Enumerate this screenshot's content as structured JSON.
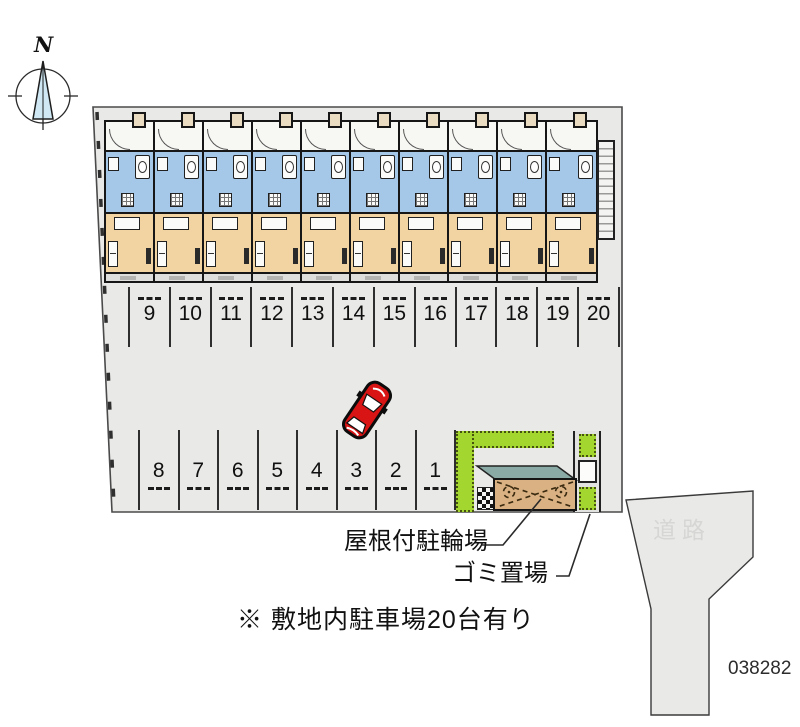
{
  "plan_id": "038282",
  "compass": {
    "label": "N"
  },
  "building": {
    "unit_count": 10
  },
  "parking": {
    "upper_row_numbers": [
      "9",
      "10",
      "11",
      "12",
      "13",
      "14",
      "15",
      "16",
      "17",
      "18",
      "19",
      "20"
    ],
    "lower_row_numbers": [
      "8",
      "7",
      "6",
      "5",
      "4",
      "3",
      "2",
      "1"
    ]
  },
  "labels": {
    "covered_bicycle_parking": "屋根付駐輪場",
    "garbage_area": "ゴミ置場",
    "site_note": "※ 敷地内駐車場20台有り",
    "road": "道路"
  },
  "colors": {
    "site_fill": "#e9e9e7",
    "unit_wet": "#a6c8e8",
    "unit_room": "#f2d4a2",
    "hedge_green": "#a3d62e",
    "bike_roof_tan": "#d9b183",
    "bike_roof_edge_teal": "#8aaaa6",
    "car_red": "#d91414",
    "compass_needle": "#cfe8f4",
    "road_text": "#d6d6d4"
  }
}
